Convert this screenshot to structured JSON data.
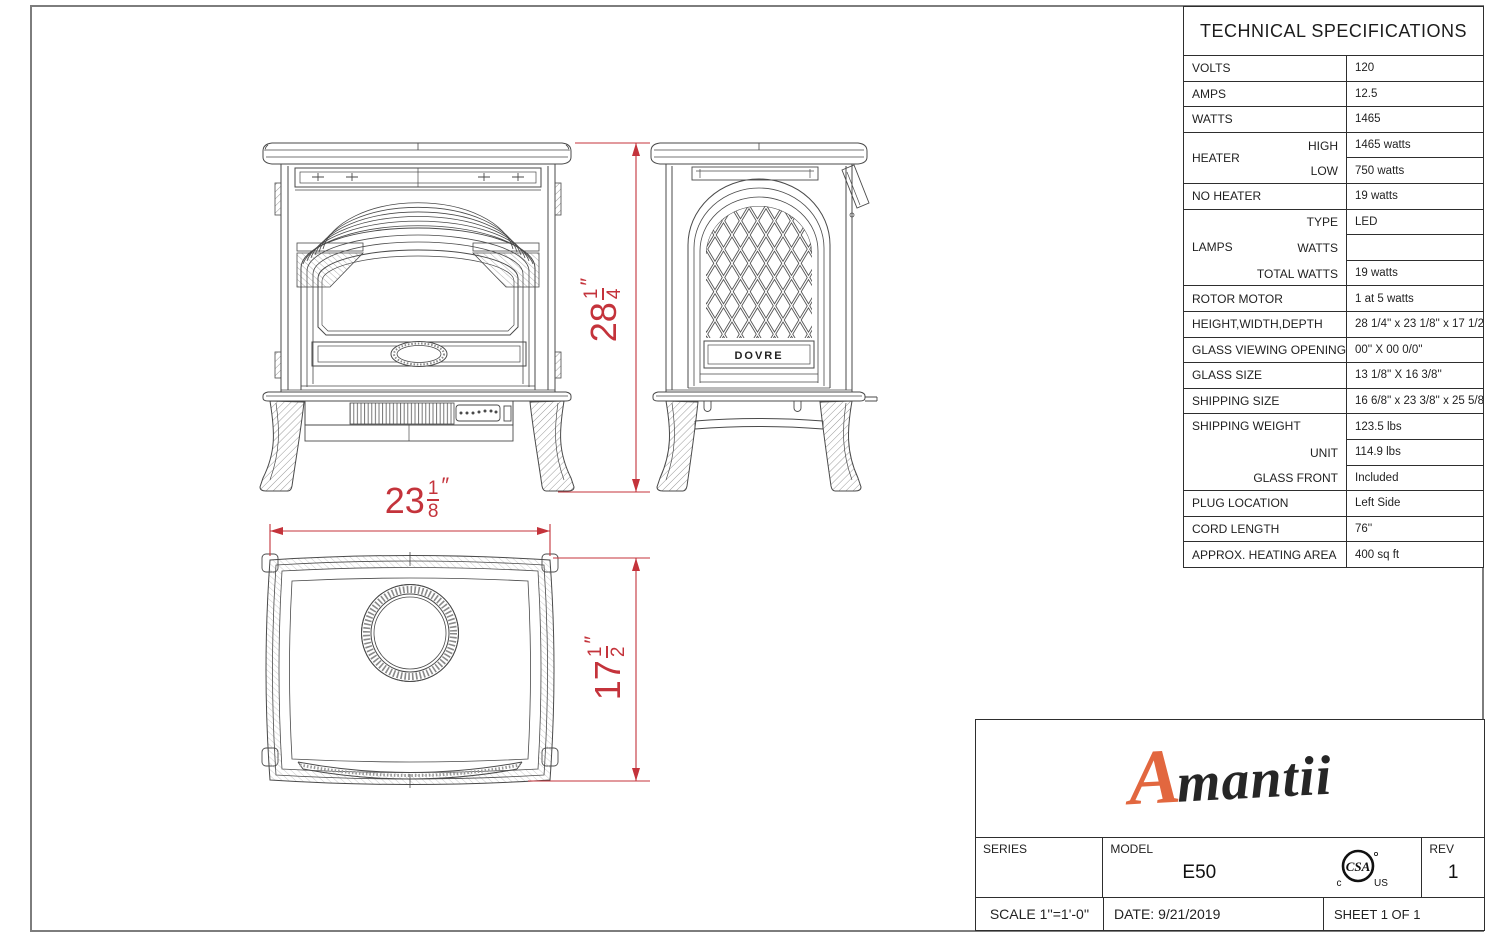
{
  "spec": {
    "title": "TECHNICAL SPECIFICATIONS",
    "groups": {
      "heater": "HEATER",
      "lamps": "LAMPS",
      "shipping": "SHIPPING WEIGHT"
    },
    "rows": [
      {
        "label": "VOLTS",
        "value": "120"
      },
      {
        "label": "AMPS",
        "value": "12.5"
      },
      {
        "label": "WATTS",
        "value": "1465"
      },
      {
        "label": "HIGH",
        "value": "1465 watts"
      },
      {
        "label": "LOW",
        "value": "750 watts"
      },
      {
        "label": "NO HEATER",
        "value": "19 watts"
      },
      {
        "label": "TYPE",
        "value": "LED"
      },
      {
        "label": "WATTS",
        "value": ""
      },
      {
        "label": "TOTAL WATTS",
        "value": "19 watts"
      },
      {
        "label": "ROTOR MOTOR",
        "value": "1 at 5 watts"
      },
      {
        "label": "HEIGHT,WIDTH,DEPTH",
        "value": "28 1/4'' x 23 1/8'' x 17 1/2''"
      },
      {
        "label": "GLASS VIEWING OPENING",
        "value": "00'' X 00 0/0''"
      },
      {
        "label": "GLASS SIZE",
        "value": "13 1/8'' X 16 3/8''"
      },
      {
        "label": "SHIPPING SIZE",
        "value": "16 6/8'' x 23 3/8'' x 25 5/8''"
      },
      {
        "label": "SHIPPING WEIGHT",
        "value": "123.5 lbs"
      },
      {
        "label": "UNIT",
        "value": "114.9 lbs"
      },
      {
        "label": "GLASS FRONT",
        "value": "Included"
      },
      {
        "label": "PLUG LOCATION",
        "value": "Left Side"
      },
      {
        "label": "CORD LENGTH",
        "value": "76''"
      },
      {
        "label": "APPROX. HEATING AREA",
        "value": "400 sq ft"
      }
    ]
  },
  "dims": {
    "height": {
      "whole": "28",
      "num": "1",
      "den": "4",
      "unit": "″"
    },
    "width": {
      "whole": "23",
      "num": "1",
      "den": "8",
      "unit": "″"
    },
    "depth": {
      "whole": "17",
      "num": "1",
      "den": "2",
      "unit": "″"
    }
  },
  "drawing": {
    "plaque": "DOVRE"
  },
  "title_block": {
    "logo_a": "A",
    "logo_rest": "mantii",
    "series_label": "SERIES",
    "model_label": "MODEL",
    "model": "E50",
    "rev_label": "REV",
    "rev": "1",
    "scale": "SCALE 1''=1'-0''",
    "date": "DATE:  9/21/2019",
    "sheet": "SHEET 1 OF 1",
    "csa": "CSA",
    "csa_c": "c",
    "csa_us": "US"
  },
  "colors": {
    "dimension_red": "#c4333b",
    "logo_orange": "#e2673f",
    "line_gray": "#4a4a4a"
  }
}
